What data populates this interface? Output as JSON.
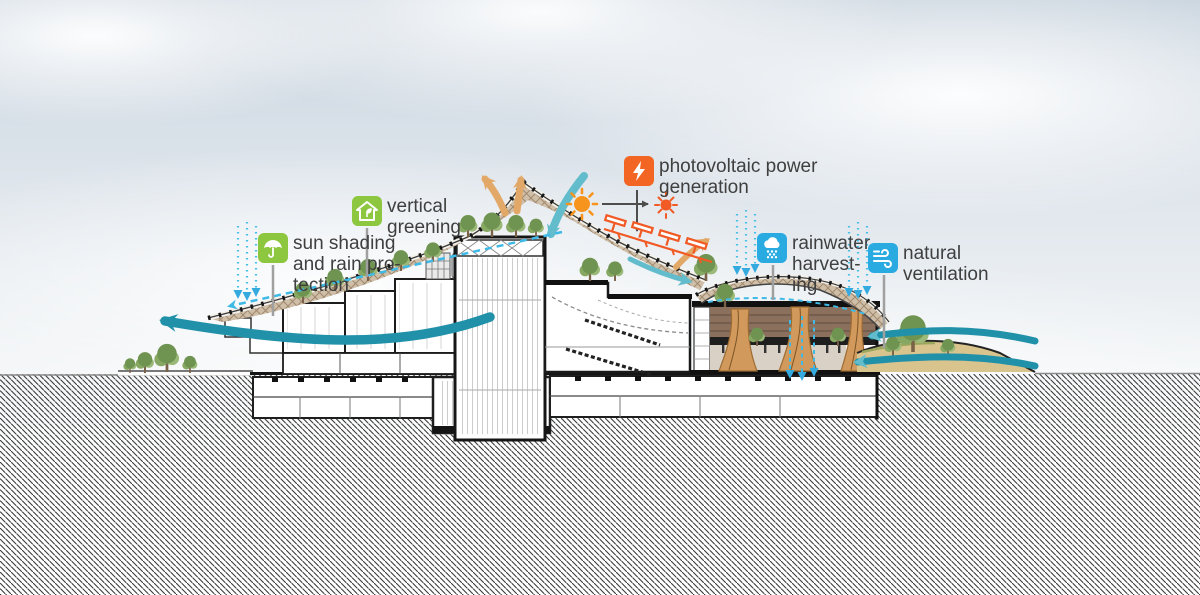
{
  "scene": {
    "type": "architectural-section-sustainability-diagram",
    "subject": "building section with passive/active green strategies"
  },
  "annotations": [
    {
      "id": "sun-shading",
      "icon": "umbrella-icon",
      "color": "#8dc63f",
      "lines": [
        "sun shading",
        "and rain pro-",
        "tection"
      ]
    },
    {
      "id": "vertical-greening",
      "icon": "house-plant-icon",
      "color": "#8dc63f",
      "lines": [
        "vertical",
        "greening"
      ]
    },
    {
      "id": "photovoltaic",
      "icon": "lightning-icon",
      "color": "#f26522",
      "lines": [
        "photovoltaic power",
        "generation"
      ]
    },
    {
      "id": "rainwater",
      "icon": "rain-cloud-icon",
      "color": "#29abe2",
      "lines": [
        "rainwater",
        "harvest-",
        "ing"
      ]
    },
    {
      "id": "ventilation",
      "icon": "wind-icon",
      "color": "#29abe2",
      "lines": [
        "natural",
        "ventilation"
      ]
    }
  ],
  "icons": [
    "umbrella-icon",
    "house-plant-icon",
    "lightning-icon",
    "rain-cloud-icon",
    "wind-icon",
    "sun-icon",
    "light-glow-icon",
    "solar-panel-icon"
  ],
  "colors": {
    "label_green": "#8dc63f",
    "label_orange": "#f26522",
    "label_blue": "#29abe2",
    "wind_teal": "#2191a9",
    "rain_cyan": "#3fb9e6",
    "thermal_tan": "#e2a868",
    "solar_orange": "#f15a24",
    "lattice_brown": "#9b8267",
    "text": "#3f3f3f"
  }
}
